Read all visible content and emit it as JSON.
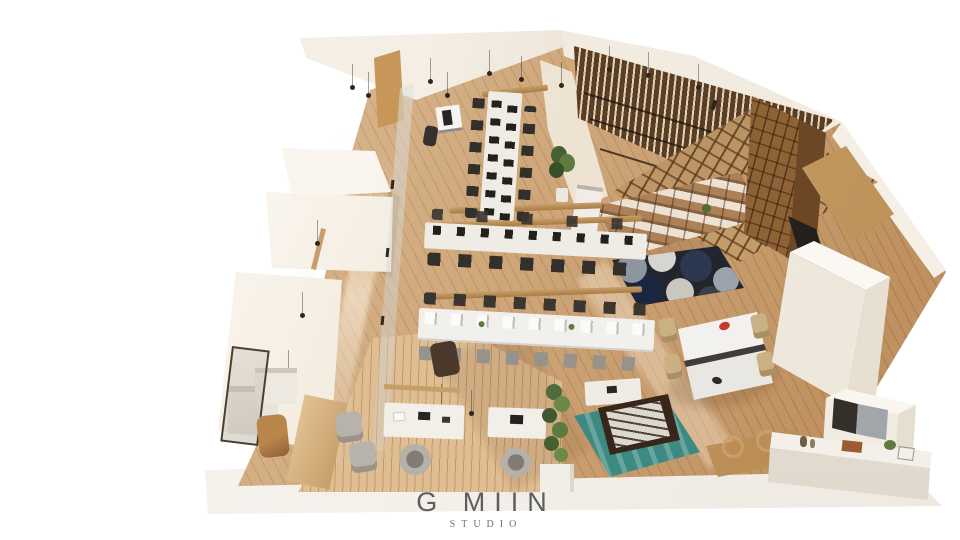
{
  "caption": {
    "brand": "G MIIN",
    "studio": "STUDIO"
  },
  "palette": {
    "background": "#ffffff",
    "floor_wood": "#c89a67",
    "floor_light": "#d2a977",
    "wall_cream": "#f4eee5",
    "wall_shadow": "#e6d8c3",
    "wood_beam": "#c79e69",
    "pergola_wood": "#c9a270",
    "slat_wood": "#8a6844",
    "locker_wood": "#8f6236",
    "desk_white": "#efece6",
    "monitor_dark": "#24211d",
    "chair_dark": "#33302b",
    "chair_grey": "#97928a",
    "rug_navy": "#23252e",
    "rug_grey": "#8d95a0",
    "rug_light": "#d7d5d0",
    "rug_teal": "#3d8a83",
    "foosball_brown": "#38261a",
    "paddle_red": "#c23b2c",
    "plant_green": "#4e6b3a",
    "caption_text": "#5e5e5e"
  }
}
